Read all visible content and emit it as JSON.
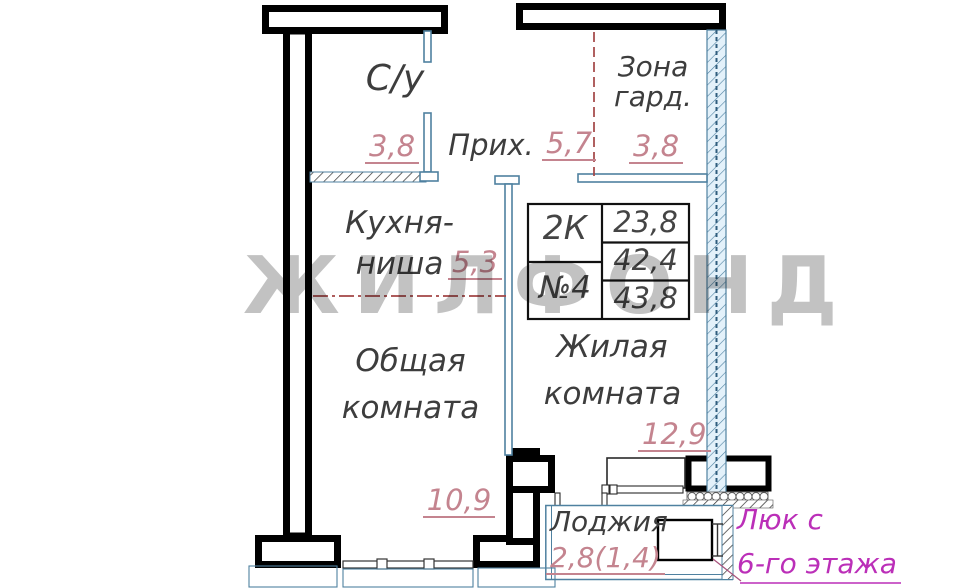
{
  "watermark": "ЖИЛФОНД",
  "rooms": {
    "bathroom": {
      "label": "С/у",
      "area": "3,8"
    },
    "hallway": {
      "label": "Прих.",
      "area": "5,7"
    },
    "wardrobe": {
      "label_line1": "Зона",
      "label_line2": "гард.",
      "area": "3,8"
    },
    "kitchen": {
      "label_line1": "Кухня-",
      "label_line2": "ниша",
      "area": "5,3"
    },
    "common_room": {
      "label_line1": "Общая",
      "label_line2": "комната",
      "area": "10,9"
    },
    "living_room": {
      "label_line1": "Жилая",
      "label_line2": "комната",
      "area": "12,9"
    },
    "loggia": {
      "label": "Лоджия",
      "area": "2,8(1,4)"
    }
  },
  "info_table": {
    "unit_type": "2К",
    "unit_number": "№4",
    "living_area": "23,8",
    "area_without_balcony": "42,4",
    "area_total": "43,8"
  },
  "hatch_note": {
    "line1": "Люк с",
    "line2": "6-го этажа"
  },
  "colors": {
    "wall": "#000000",
    "partition": "#4f81a0",
    "area_value": "#c4848f",
    "zone_line": "#a34545",
    "note": "#bb2fb8",
    "watermark_gray": "#909090",
    "label": "#3d3d3d"
  }
}
